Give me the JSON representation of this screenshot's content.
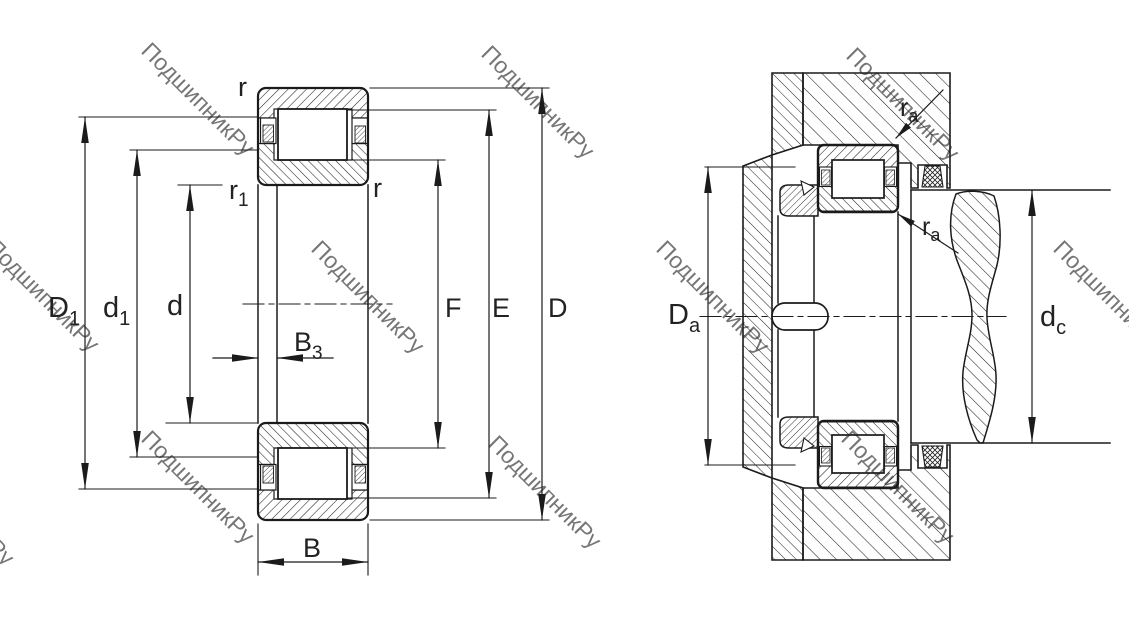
{
  "drawing": {
    "type": "cylindrical-roller-bearing-dimension-drawing",
    "views": [
      "bearing-cross-section",
      "mounted-arrangement"
    ]
  },
  "watermark": {
    "text": "ПодшипникРу",
    "color": "#bdbdbd"
  },
  "left_view": {
    "labels": {
      "r_top": "r",
      "r1_main": "r",
      "r1_sub": "1",
      "r_right": "r",
      "D1_main": "D",
      "D1_sub": "1",
      "d1_main": "d",
      "d1_sub": "1",
      "d": "d",
      "B3_main": "B",
      "B3_sub": "3",
      "B": "B",
      "F": "F",
      "E": "E",
      "D": "D"
    }
  },
  "right_view": {
    "labels": {
      "ra_top_main": "r",
      "ra_top_sub": "a",
      "ra_bot_main": "r",
      "ra_bot_sub": "a",
      "Da_main": "D",
      "Da_sub": "a",
      "dc_main": "d",
      "dc_sub": "c"
    }
  }
}
